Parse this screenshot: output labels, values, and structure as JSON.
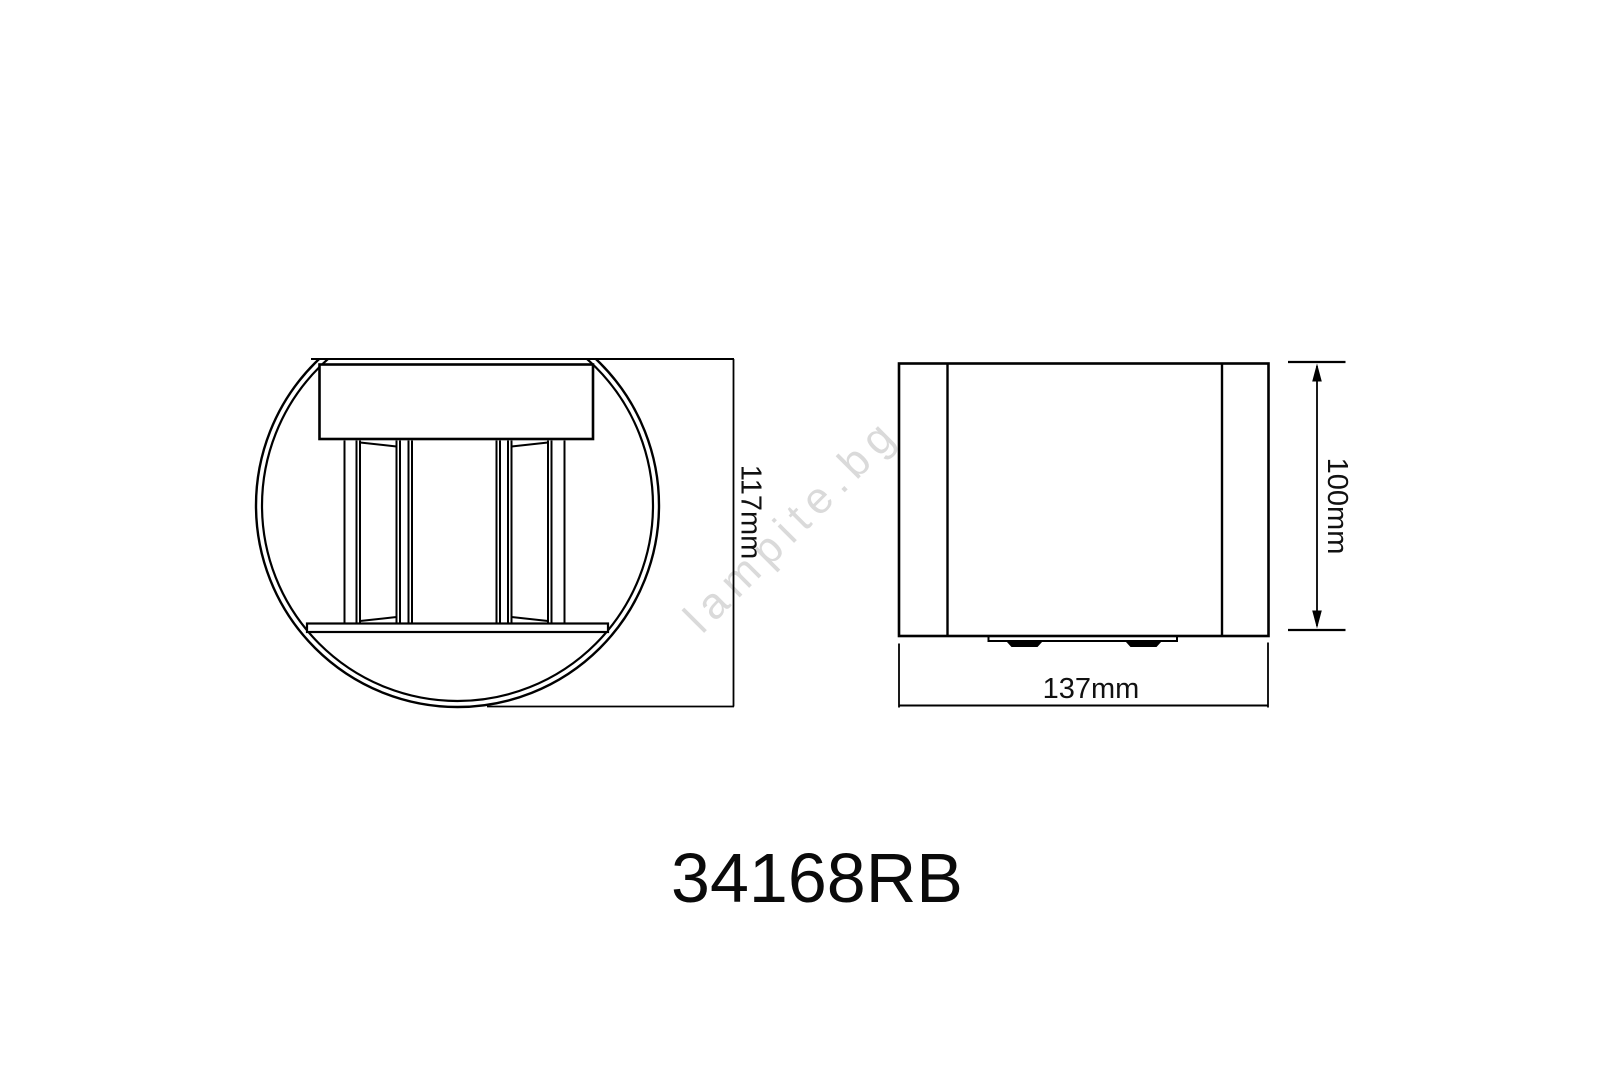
{
  "title": {
    "code": "34168RB"
  },
  "watermark": {
    "text": "lampite.bg",
    "color": "#d6d6d6"
  },
  "front_view": {
    "name": "front view (round wall light)",
    "height_dim": "117mm"
  },
  "side_view": {
    "name": "side view",
    "height_dim": "100mm",
    "width_dim": "137mm"
  },
  "colors": {
    "line": "#000000",
    "text": "#111111",
    "background": "#ffffff"
  }
}
